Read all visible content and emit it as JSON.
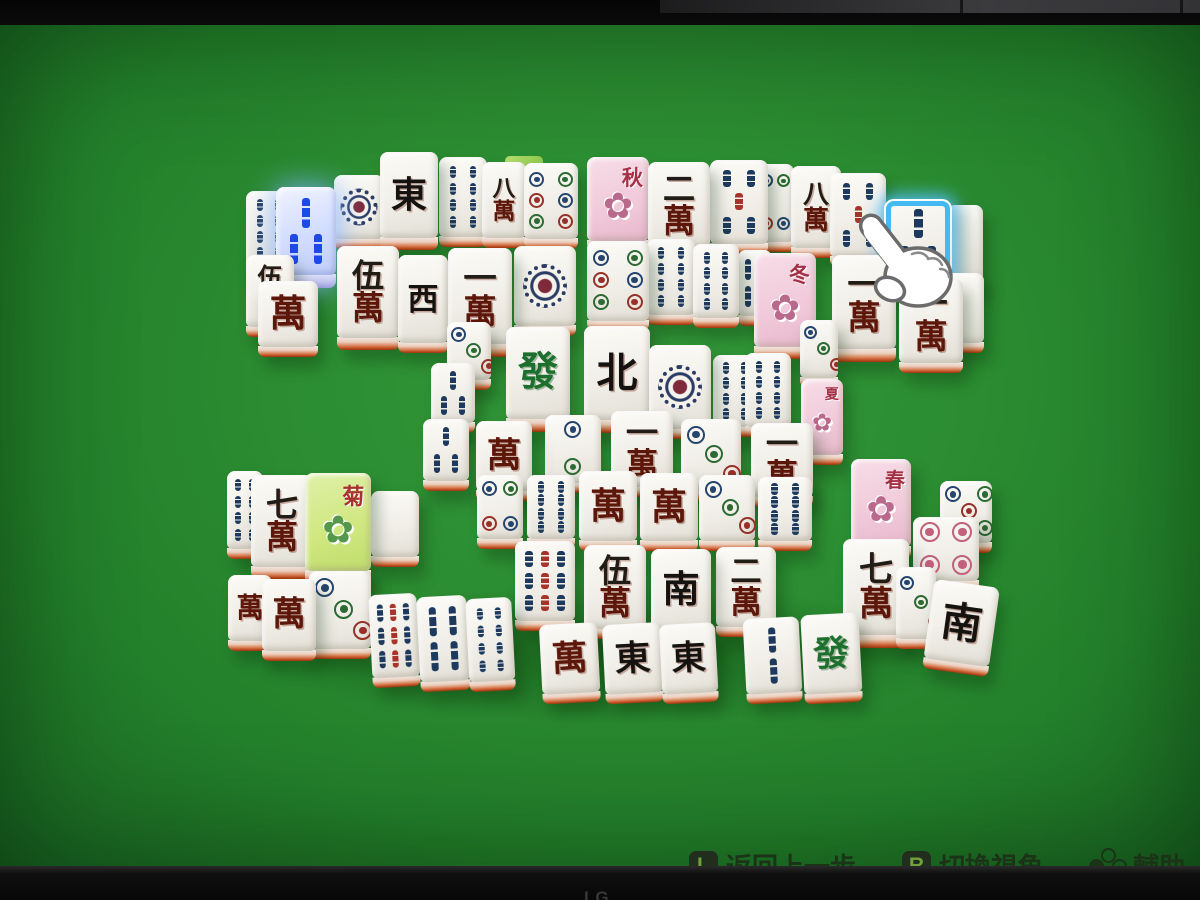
{
  "frame": {
    "brand": "LG"
  },
  "hud": {
    "hints": [
      {
        "key": "L",
        "label": "返回上一步"
      },
      {
        "key": "R",
        "label": "切換視角"
      },
      {
        "key": "",
        "icon": "face-buttons",
        "label": "輔助"
      }
    ]
  },
  "colors": {
    "felt": "#2b8c31",
    "highlight_blue": "#44b9f2",
    "selected_blue": "#1b49e8",
    "tile_edge_orange": "#c14e23"
  },
  "cursor": {
    "type": "hand-pointer",
    "x": 848,
    "y": 186
  },
  "board": {
    "selected_tile": "3-bamboo",
    "hover_tile": "3-bamboo",
    "tiles": [
      {
        "x": 246,
        "y": 166,
        "w": 46,
        "h": 76,
        "t": "bamboo",
        "v": 8
      },
      {
        "x": 276,
        "y": 162,
        "w": 60,
        "h": 88,
        "d": 14,
        "t": "bamboo",
        "v": 3,
        "sel": 1
      },
      {
        "x": 334,
        "y": 150,
        "w": 50,
        "h": 64,
        "t": "dots",
        "v": 1
      },
      {
        "x": 380,
        "y": 127,
        "w": 58,
        "h": 86,
        "d": 13,
        "t": "wind",
        "v": "東"
      },
      {
        "x": 439,
        "y": 132,
        "w": 48,
        "h": 80,
        "t": "bamboo",
        "v": 8
      },
      {
        "x": 482,
        "y": 137,
        "w": 44,
        "h": 76,
        "t": "char",
        "v": "八萬"
      },
      {
        "x": 505,
        "y": 131,
        "w": 38,
        "h": 14,
        "t": "edge"
      },
      {
        "x": 524,
        "y": 138,
        "w": 54,
        "h": 76,
        "t": "dots",
        "v": 6
      },
      {
        "x": 587,
        "y": 132,
        "w": 62,
        "h": 84,
        "t": "flower",
        "v": "秋",
        "bg": "p"
      },
      {
        "x": 648,
        "y": 137,
        "w": 62,
        "h": 86,
        "t": "char",
        "v": "二萬"
      },
      {
        "x": 710,
        "y": 135,
        "w": 58,
        "h": 84,
        "t": "bamboo",
        "v": 5
      },
      {
        "x": 756,
        "y": 139,
        "w": 38,
        "h": 78,
        "t": "dots",
        "v": 4
      },
      {
        "x": 791,
        "y": 141,
        "w": 50,
        "h": 82,
        "t": "char",
        "v": "八萬"
      },
      {
        "x": 830,
        "y": 148,
        "w": 56,
        "h": 84,
        "t": "bamboo",
        "v": 5
      },
      {
        "x": 884,
        "y": 174,
        "w": 68,
        "h": 86,
        "d": 13,
        "t": "bamboo",
        "v": 3,
        "hov": 1
      },
      {
        "x": 947,
        "y": 180,
        "w": 36,
        "h": 76,
        "t": "blank"
      },
      {
        "x": 246,
        "y": 230,
        "w": 48,
        "h": 72,
        "t": "char",
        "v": "伍萬"
      },
      {
        "x": 258,
        "y": 256,
        "w": 60,
        "h": 66,
        "t": "char",
        "v": "萬"
      },
      {
        "x": 337,
        "y": 221,
        "w": 62,
        "h": 92,
        "d": 13,
        "t": "char",
        "v": "伍萬"
      },
      {
        "x": 398,
        "y": 230,
        "w": 50,
        "h": 88,
        "t": "wind",
        "v": "西"
      },
      {
        "x": 448,
        "y": 223,
        "w": 64,
        "h": 96,
        "d": 14,
        "t": "char",
        "v": "一萬"
      },
      {
        "x": 514,
        "y": 221,
        "w": 62,
        "h": 80,
        "t": "dots",
        "v": 1
      },
      {
        "x": 587,
        "y": 216,
        "w": 62,
        "h": 80,
        "t": "dots",
        "v": 6
      },
      {
        "x": 647,
        "y": 214,
        "w": 48,
        "h": 76,
        "t": "bamboo",
        "v": 8
      },
      {
        "x": 693,
        "y": 219,
        "w": 46,
        "h": 74,
        "t": "bamboo",
        "v": 8
      },
      {
        "x": 738,
        "y": 225,
        "w": 34,
        "h": 66,
        "t": "bamboo",
        "v": 4
      },
      {
        "x": 754,
        "y": 228,
        "w": 62,
        "h": 94,
        "d": 13,
        "t": "flower",
        "v": "冬",
        "bg": "p"
      },
      {
        "x": 832,
        "y": 230,
        "w": 64,
        "h": 94,
        "d": 14,
        "t": "char",
        "v": "一萬"
      },
      {
        "x": 899,
        "y": 254,
        "w": 64,
        "h": 84,
        "t": "char",
        "v": "一萬"
      },
      {
        "x": 946,
        "y": 248,
        "w": 38,
        "h": 70,
        "t": "blank"
      },
      {
        "x": 506,
        "y": 302,
        "w": 64,
        "h": 92,
        "d": 14,
        "t": "dragon",
        "v": "發"
      },
      {
        "x": 584,
        "y": 301,
        "w": 66,
        "h": 94,
        "d": 14,
        "t": "wind",
        "v": "北"
      },
      {
        "x": 649,
        "y": 320,
        "w": 62,
        "h": 84,
        "t": "dots",
        "v": 1
      },
      {
        "x": 713,
        "y": 330,
        "w": 44,
        "h": 72,
        "t": "bamboo",
        "v": 8
      },
      {
        "x": 447,
        "y": 297,
        "w": 44,
        "h": 58,
        "t": "dots",
        "v": 3
      },
      {
        "x": 431,
        "y": 338,
        "w": 44,
        "h": 60,
        "t": "bamboo",
        "v": 3
      },
      {
        "x": 423,
        "y": 394,
        "w": 46,
        "h": 62,
        "t": "bamboo",
        "v": 3
      },
      {
        "x": 800,
        "y": 295,
        "w": 38,
        "h": 58,
        "t": "dots",
        "v": 3
      },
      {
        "x": 745,
        "y": 328,
        "w": 46,
        "h": 74,
        "t": "bamboo",
        "v": 8
      },
      {
        "x": 476,
        "y": 396,
        "w": 56,
        "h": 70,
        "t": "char",
        "v": "萬"
      },
      {
        "x": 545,
        "y": 390,
        "w": 56,
        "h": 68,
        "t": "dots",
        "v": 2
      },
      {
        "x": 611,
        "y": 386,
        "w": 62,
        "h": 76,
        "t": "char",
        "v": "一萬"
      },
      {
        "x": 681,
        "y": 394,
        "w": 60,
        "h": 72,
        "t": "dots",
        "v": 3
      },
      {
        "x": 751,
        "y": 398,
        "w": 62,
        "h": 74,
        "t": "char",
        "v": "一萬"
      },
      {
        "x": 801,
        "y": 354,
        "w": 42,
        "h": 76,
        "t": "flower",
        "v": "夏",
        "bg": "p"
      },
      {
        "x": 227,
        "y": 446,
        "w": 36,
        "h": 78,
        "t": "bamboo",
        "v": 8
      },
      {
        "x": 251,
        "y": 450,
        "w": 62,
        "h": 92,
        "d": 13,
        "t": "char",
        "v": "七萬"
      },
      {
        "x": 305,
        "y": 448,
        "w": 66,
        "h": 98,
        "d": 14,
        "t": "flower",
        "v": "菊",
        "bg": "g"
      },
      {
        "x": 371,
        "y": 466,
        "w": 48,
        "h": 66,
        "t": "blank"
      },
      {
        "x": 477,
        "y": 450,
        "w": 46,
        "h": 64,
        "t": "dots",
        "v": 4
      },
      {
        "x": 527,
        "y": 450,
        "w": 48,
        "h": 64,
        "t": "bamboo",
        "v": 8
      },
      {
        "x": 579,
        "y": 446,
        "w": 58,
        "h": 70,
        "t": "char",
        "v": "萬"
      },
      {
        "x": 640,
        "y": 448,
        "w": 58,
        "h": 68,
        "t": "char",
        "v": "萬"
      },
      {
        "x": 699,
        "y": 450,
        "w": 56,
        "h": 66,
        "t": "dots",
        "v": 3
      },
      {
        "x": 758,
        "y": 452,
        "w": 54,
        "h": 64,
        "t": "bamboo",
        "v": 8
      },
      {
        "x": 851,
        "y": 434,
        "w": 60,
        "h": 88,
        "d": 13,
        "t": "flower",
        "v": "春",
        "bg": "p"
      },
      {
        "x": 940,
        "y": 456,
        "w": 52,
        "h": 62,
        "t": "dots",
        "v": 5
      },
      {
        "x": 228,
        "y": 550,
        "w": 44,
        "h": 66,
        "t": "char",
        "v": "萬"
      },
      {
        "x": 262,
        "y": 554,
        "w": 54,
        "h": 72,
        "t": "char",
        "v": "萬"
      },
      {
        "x": 309,
        "y": 546,
        "w": 62,
        "h": 78,
        "t": "dots",
        "v": 3
      },
      {
        "x": 373,
        "y": 566,
        "w": 48,
        "h": 86,
        "t": "bamboo",
        "v": 9,
        "tilt": 1
      },
      {
        "x": 421,
        "y": 568,
        "w": 50,
        "h": 88,
        "t": "bamboo",
        "v": 4,
        "tilt": 1
      },
      {
        "x": 470,
        "y": 570,
        "w": 46,
        "h": 86,
        "t": "bamboo",
        "v": 8,
        "tilt": 1
      },
      {
        "x": 515,
        "y": 516,
        "w": 60,
        "h": 80,
        "t": "bamboo",
        "v": 9
      },
      {
        "x": 584,
        "y": 520,
        "w": 62,
        "h": 84,
        "t": "char",
        "v": "伍萬"
      },
      {
        "x": 651,
        "y": 524,
        "w": 60,
        "h": 82,
        "t": "wind",
        "v": "南"
      },
      {
        "x": 716,
        "y": 522,
        "w": 60,
        "h": 80,
        "t": "char",
        "v": "二萬"
      },
      {
        "x": 843,
        "y": 514,
        "w": 66,
        "h": 96,
        "d": 14,
        "t": "char",
        "v": "七萬"
      },
      {
        "x": 543,
        "y": 596,
        "w": 58,
        "h": 72,
        "t": "char",
        "v": "萬",
        "tilt": 1
      },
      {
        "x": 606,
        "y": 596,
        "w": 58,
        "h": 72,
        "t": "wind",
        "v": "東",
        "tilt": 1
      },
      {
        "x": 663,
        "y": 596,
        "w": 56,
        "h": 72,
        "t": "wind",
        "v": "東",
        "tilt": 1
      },
      {
        "x": 747,
        "y": 590,
        "w": 56,
        "h": 78,
        "t": "bamboo",
        "v": 2,
        "tilt": 1
      },
      {
        "x": 805,
        "y": 586,
        "w": 58,
        "h": 82,
        "t": "dragon",
        "v": "發",
        "tilt": 1
      },
      {
        "x": 913,
        "y": 492,
        "w": 66,
        "h": 64,
        "t": "dots",
        "v": 4,
        "pink": 1
      },
      {
        "x": 928,
        "y": 558,
        "w": 66,
        "h": 80,
        "t": "wind",
        "v": "南",
        "rot": 8
      },
      {
        "x": 896,
        "y": 542,
        "w": 40,
        "h": 72,
        "t": "dots",
        "v": 3
      }
    ]
  }
}
